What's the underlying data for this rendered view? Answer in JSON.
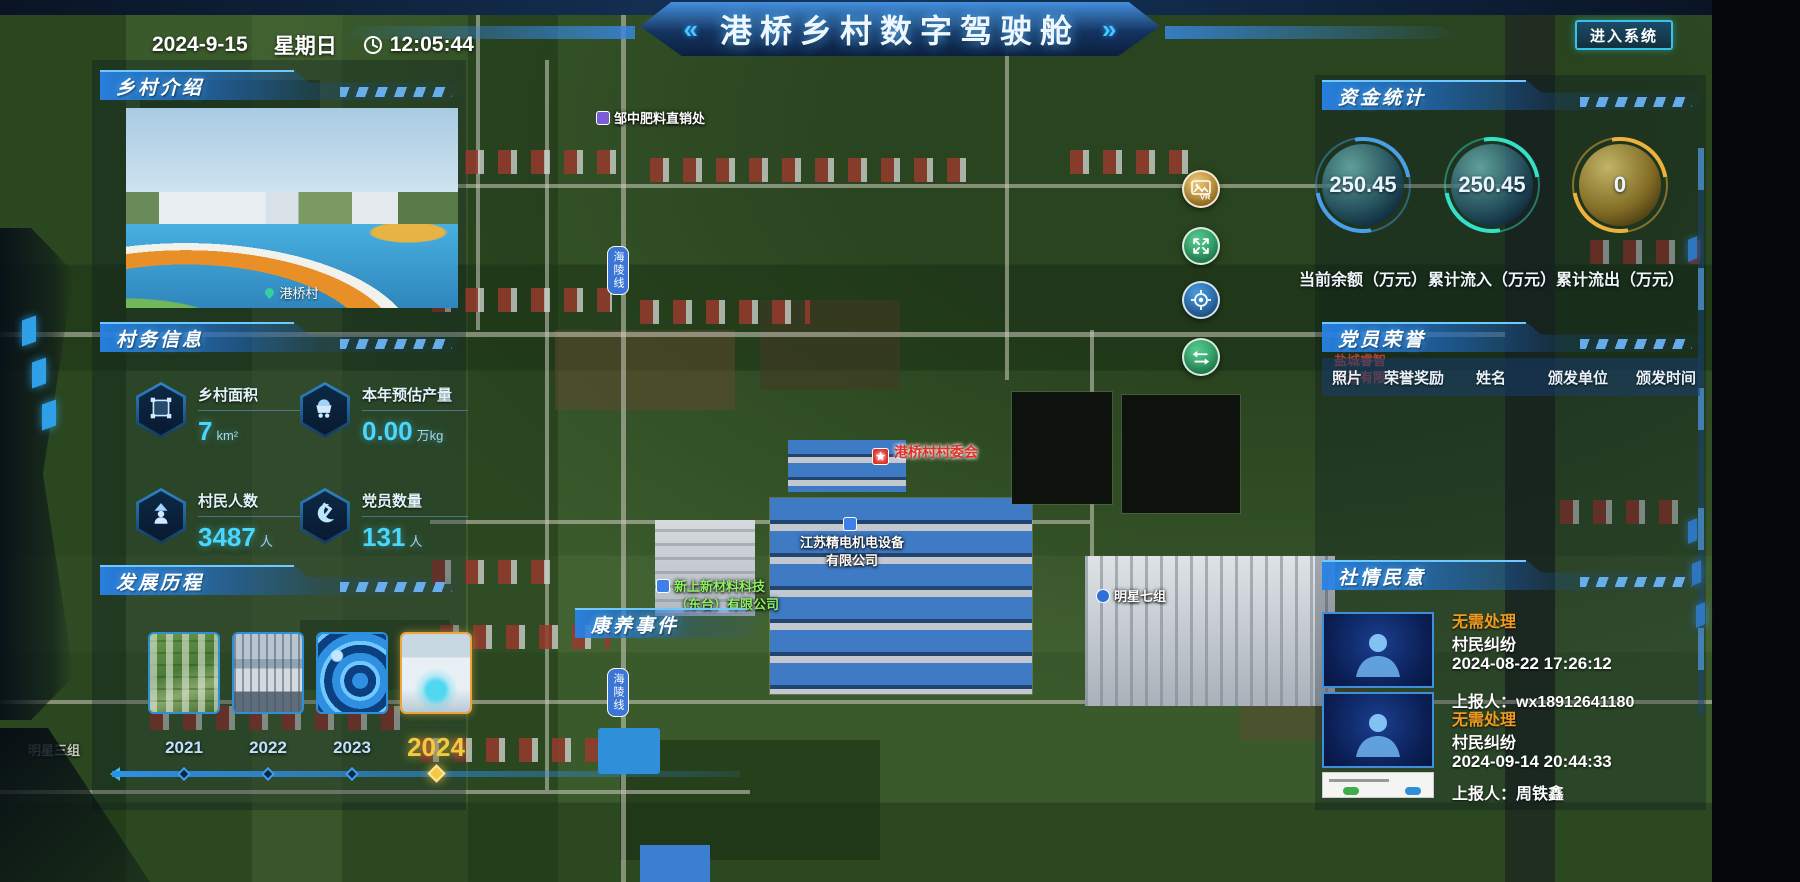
{
  "header": {
    "date": "2024-9-15",
    "weekday": "星期日",
    "time": "12:05:44",
    "title": "港桥乡村数字驾驶舱",
    "chev_left": "«",
    "chev_right": "»",
    "enter_button": "进入系统"
  },
  "village_intro": {
    "title": "乡村介绍",
    "photo_caption": "港桥村"
  },
  "village_info": {
    "title": "村务信息",
    "stats": [
      {
        "icon": "area-icon",
        "label": "乡村面积",
        "value": "7",
        "unit": "km²"
      },
      {
        "icon": "output-cart-icon",
        "label": "本年预估产量",
        "value": "0.00",
        "unit": "万kg"
      },
      {
        "icon": "villagers-icon",
        "label": "村民人数",
        "value": "3487",
        "unit": "人"
      },
      {
        "icon": "party-member-icon",
        "label": "党员数量",
        "value": "131",
        "unit": "人"
      }
    ]
  },
  "development": {
    "title": "发展历程",
    "years": [
      "2021",
      "2022",
      "2023",
      "2024"
    ],
    "active_year": "2024"
  },
  "funds": {
    "title": "资金统计",
    "gauges": [
      {
        "value": "250.45",
        "label": "当前余额（万元）",
        "accent": "#4aa0e8"
      },
      {
        "value": "250.45",
        "label": "累计流入（万元）",
        "accent": "#35e0c8"
      },
      {
        "value": "0",
        "label": "累计流出（万元）",
        "accent": "#ecb23c"
      }
    ]
  },
  "party_honor": {
    "title": "党员荣誉",
    "columns": [
      "照片",
      "荣誉奖励",
      "姓名",
      "颁发单位",
      "颁发时间"
    ]
  },
  "sentiment": {
    "title": "社情民意",
    "items": [
      {
        "status": "无需处理",
        "category": "村民纠纷",
        "time": "2024-08-22 17:26:12",
        "reporter": "上报人：wx18912641180"
      },
      {
        "status": "无需处理",
        "category": "村民纠纷",
        "time": "2024-09-14 20:44:33",
        "reporter": "上报人：周铁鑫"
      }
    ]
  },
  "events_panel": {
    "title": "康养事件"
  },
  "map": {
    "labels": {
      "fertilizer_shop": "邹中肥料直销处",
      "village_committee": "港桥村村委会",
      "factory1_line1": "江苏精电机电设备",
      "factory1_line2": "有限公司",
      "factory2_line1": "新上新材料科技",
      "factory2_line2": "（东台）有限公司",
      "group7": "明星七组",
      "group3": "明星三组",
      "road": "海陵线",
      "covered_company_line1": "盐城睿智",
      "covered_company_line2": "制造有限公司"
    },
    "controls": {
      "vr": "VR"
    }
  },
  "colors": {
    "accent_blue": "#2f8fe8",
    "accent_cyan": "#35e0c8",
    "accent_gold": "#ecb23c",
    "status_orange": "#f09a20",
    "value_cyan": "#49d6ff",
    "year_gold": "#f5c842"
  }
}
